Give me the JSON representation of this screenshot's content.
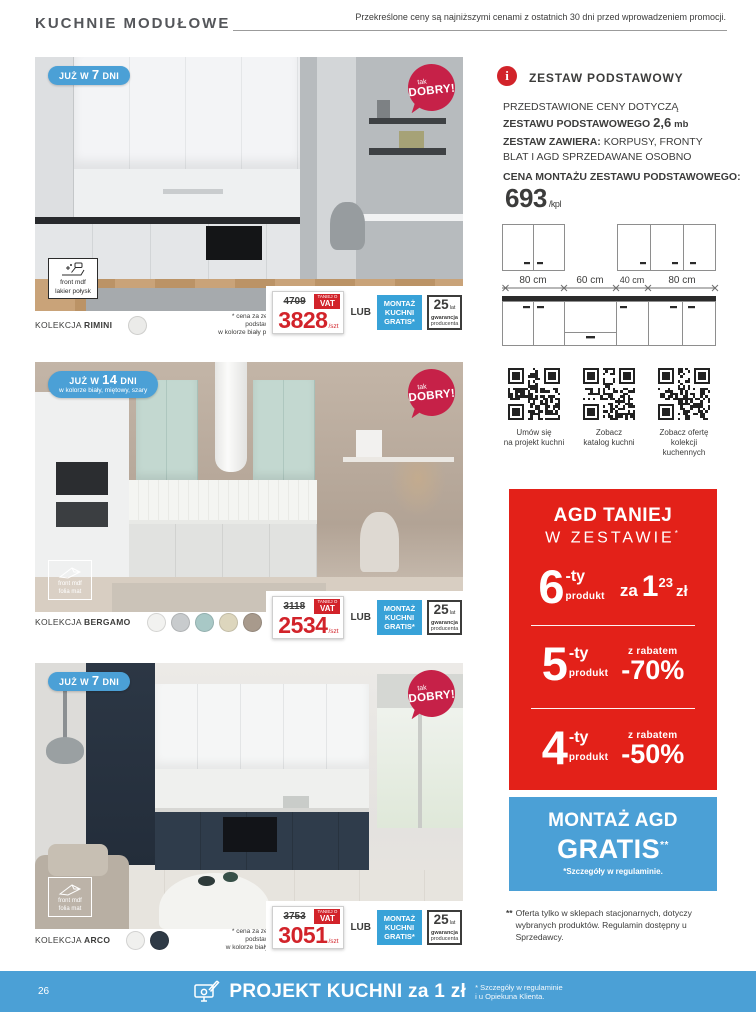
{
  "colors": {
    "badge_blue": "#4ba0d6",
    "dobry_red": "#c62148",
    "price_red": "#d2232a",
    "promo_red": "#e32119",
    "montaz_blue": "#38a2d8",
    "footer_blue": "#4ba0d6"
  },
  "header": {
    "title": "KUCHNIE MODUŁOWE",
    "note": "Przekreślone ceny są najniższymi cenami z ostatnich 30 dni przed wprowadzeniem promocji."
  },
  "shared": {
    "dobry_line1": "tak",
    "dobry_line2": "DOBRY!",
    "vat_line1": "TANIEJ O",
    "vat_line2": "VAT",
    "lub": "LUB",
    "montaz_kuchni": "MONTAŻ KUCHNI GRATIS*",
    "warranty_num": "25",
    "warranty_unit": "lat",
    "warranty_line1": "gwarancja",
    "warranty_line2": "producenta",
    "collection_prefix": "KOLEKCJA"
  },
  "products": [
    {
      "badge_pre": "JUŻ W",
      "badge_num": "7",
      "badge_post": "DNI",
      "badge_sub": "",
      "material_line1": "front mdf",
      "material_line2": "lakier połysk",
      "collection": "RIMINI",
      "note_lines": "* cena za zestaw\npodstawowy\nw kolorze biały połysk",
      "old_price": "4709",
      "price": "3828",
      "unit": "/szt",
      "swatches": [
        "#ebebe9"
      ]
    },
    {
      "badge_pre": "JUŻ W",
      "badge_num": "14",
      "badge_post": "DNI",
      "badge_sub": "w kolorze biały, miętowy, szary",
      "material_line1": "front mdf",
      "material_line2": "folia mat",
      "collection": "BERGAMO",
      "note_lines": "* cena za zestaw\npodstawowy\nw kolorze\nszary+mięta",
      "old_price": "3118",
      "price": "2534",
      "unit": "/szt",
      "swatches": [
        "#f2f2f0",
        "#c8cbcd",
        "#a8c8c6",
        "#ddd6bd",
        "#a89a8c",
        "#4f5156"
      ]
    },
    {
      "badge_pre": "JUŻ W",
      "badge_num": "7",
      "badge_post": "DNI",
      "badge_sub": "",
      "material_line1": "front mdf",
      "material_line2": "folia mat",
      "collection": "ARCO",
      "note_lines": "* cena za zestaw\npodstawowy\nw kolorze biały mat",
      "old_price": "3753",
      "price": "3051",
      "unit": "/szt",
      "swatches": [
        "#f0f0ee",
        "#2f3a46"
      ]
    }
  ],
  "info": {
    "icon_glyph": "i",
    "heading": "ZESTAW PODSTAWOWY",
    "p1_line1": "PRZEDSTAWIONE CENY DOTYCZĄ",
    "p1_bold": "ZESTAWU PODSTAWOWEGO",
    "p1_num": "2,6",
    "p1_unit": "mb",
    "p2_bold": "ZESTAW ZAWIERA:",
    "p2_rest": " KORPUSY, FRONTY",
    "p2_line2": "BLAT I AGD SPRZEDAWANE OSOBNO",
    "montage_label": "CENA MONTAŻU ZESTAWU PODSTAWOWEGO:",
    "montage_price": "693",
    "montage_unit": "/kpl"
  },
  "diagram": {
    "dims": [
      "80 cm",
      "60 cm",
      "40 cm",
      "80 cm"
    ]
  },
  "qr_items": [
    {
      "line1": "Umów się",
      "line2": "na projekt kuchni"
    },
    {
      "line1": "Zobacz",
      "line2": "katalog kuchni"
    },
    {
      "line1": "Zobacz ofertę",
      "line2": "kolekcji kuchennych"
    }
  ],
  "promo": {
    "title_line1": "AGD TANIEJ",
    "title_line2": "W ZESTAWIE",
    "title_ast": "*",
    "row6_num": "6",
    "row6_ty": "-ty",
    "row6_label": "produkt",
    "row6_za": "za",
    "row6_price": "1",
    "row6_sup": "23",
    "row6_zl": "zł",
    "row5_num": "5",
    "row5_ty": "-ty",
    "row5_label": "produkt",
    "row5_top": "z rabatem",
    "row5_val": "-70%",
    "row4_num": "4",
    "row4_ty": "-ty",
    "row4_label": "produkt",
    "row4_top": "z rabatem",
    "row4_val": "-50%"
  },
  "montaz_agd": {
    "line1": "MONTAŻ AGD",
    "line2": "GRATIS",
    "ast": "**",
    "sub": "*Szczegóły w regulaminie."
  },
  "footnote": {
    "mark": "**",
    "text": "Oferta tylko w sklepach stacjonarnych, dotyczy wybranych produktów. Regulamin dostępny u Sprzedawcy."
  },
  "footer": {
    "page_number": "26",
    "title": "PROJEKT KUCHNI za 1 zł",
    "note_line1": "* Szczegóły w regulaminie",
    "note_line2": "i u Opiekuna Klienta."
  }
}
